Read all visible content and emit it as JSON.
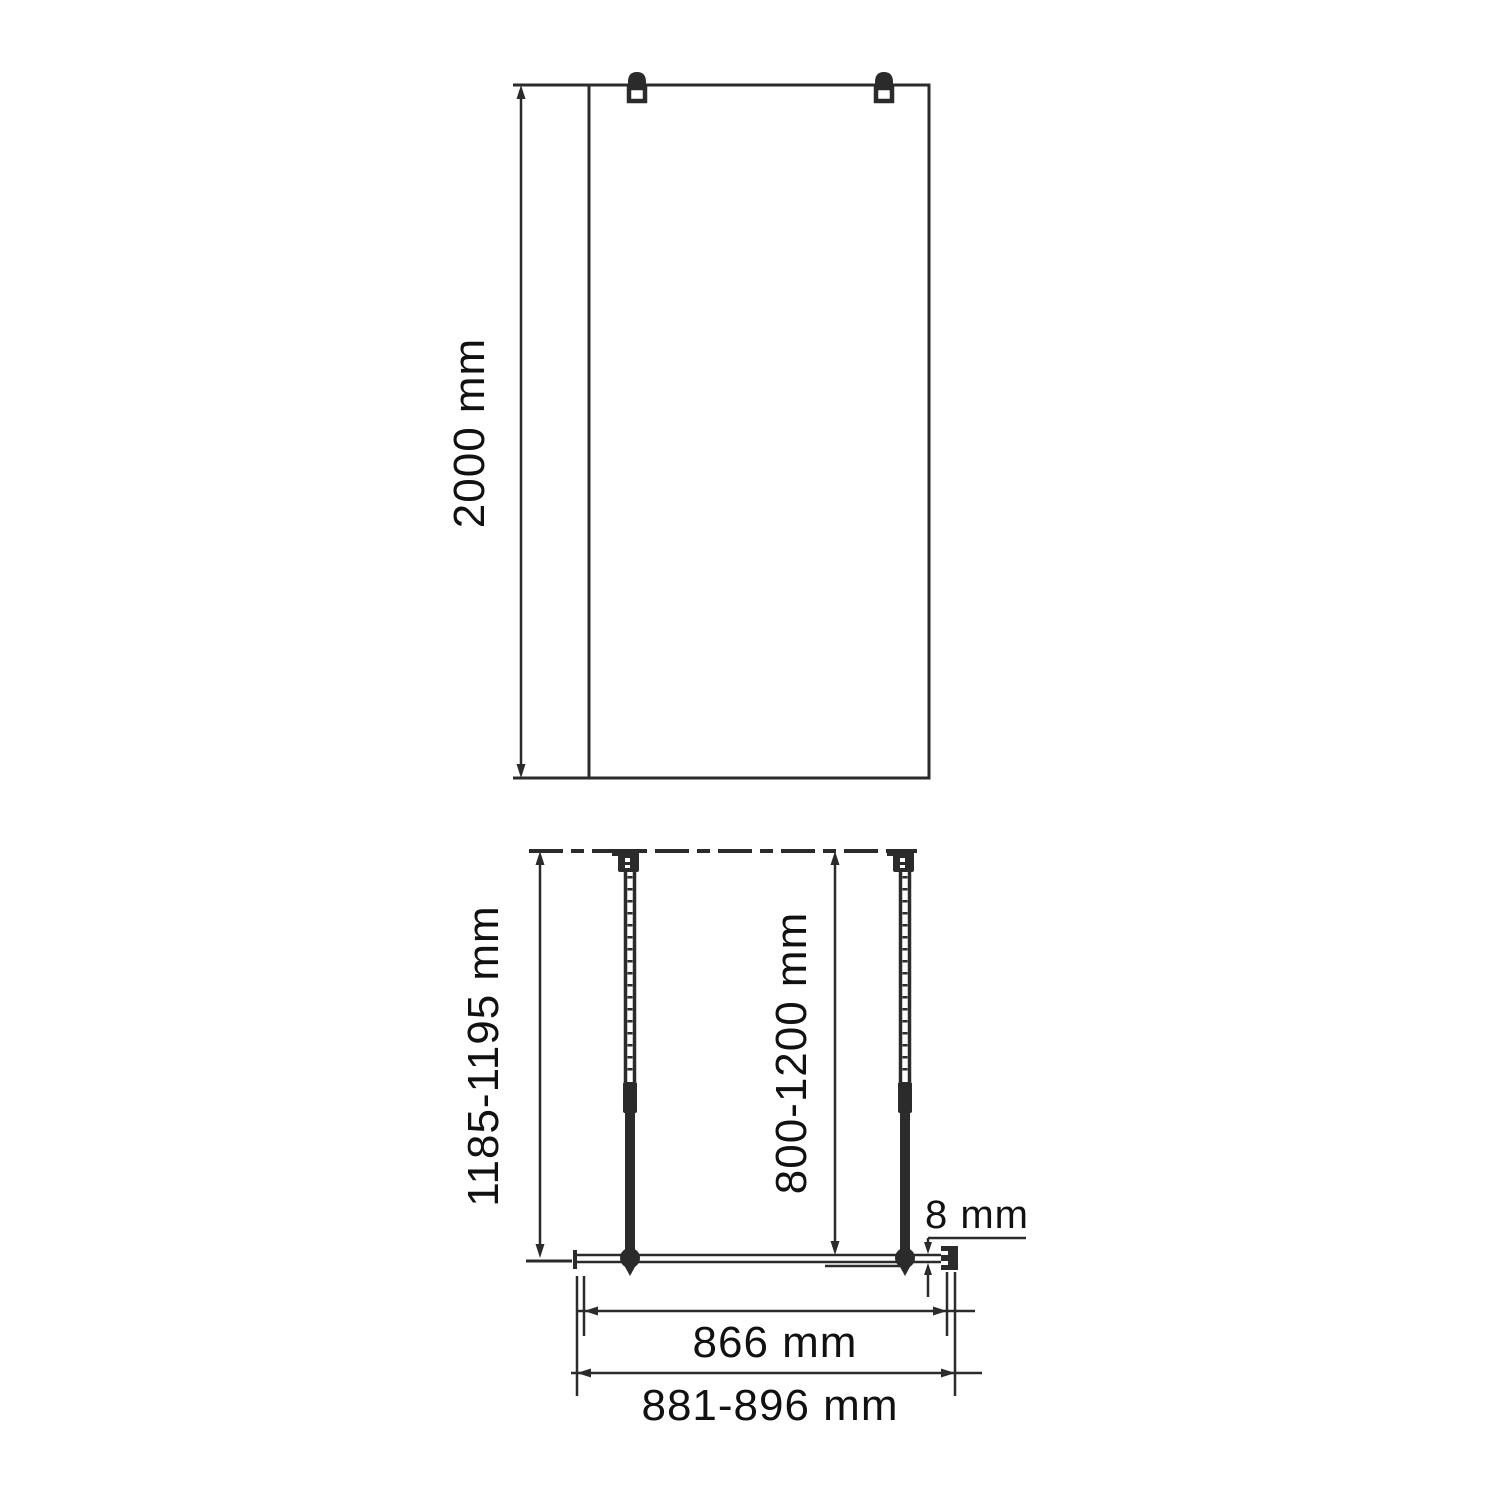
{
  "drawing": {
    "subject": "walk-in shower glass panel installation diagram",
    "colors": {
      "line": "#2b2b2b",
      "background": "#ffffff",
      "text": "#111111"
    },
    "front_view": {
      "height_dim": "2000 mm"
    },
    "plan_view": {
      "left_depth_dim": "1185-1195 mm",
      "support_bar_dim": "800-1200 mm",
      "glass_thickness_dim": "8 mm",
      "glass_width_dim": "866 mm",
      "install_width_dim": "881-896 mm"
    }
  }
}
